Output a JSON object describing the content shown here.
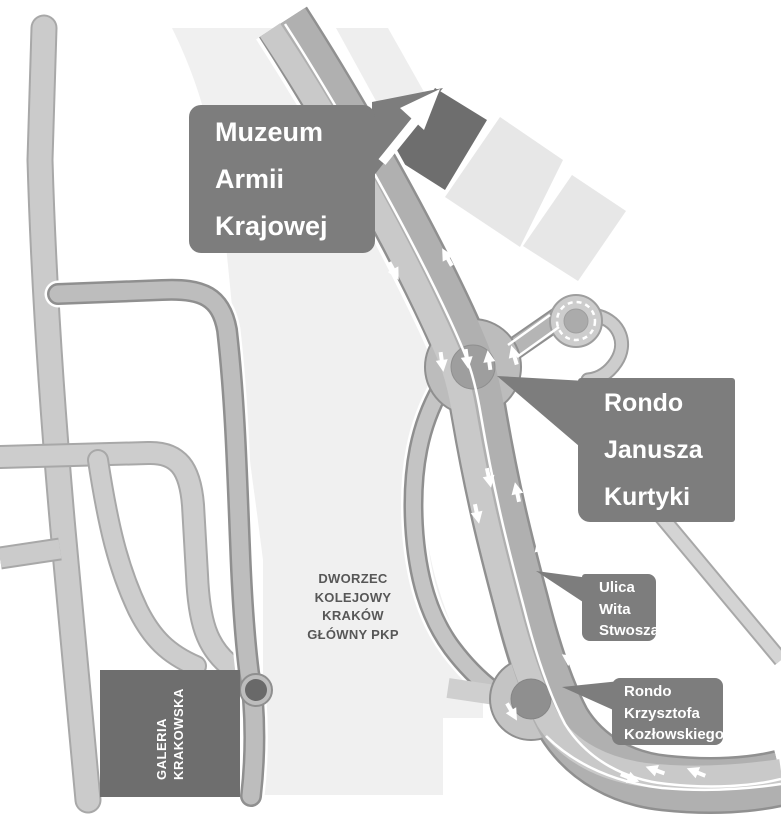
{
  "map": {
    "title_context": "Kraków Główny station area map",
    "labels": {
      "muzeum": "Muzeum\nArmii\nKrajowej",
      "rondo_kurtyki": "Rondo\nJanusza\nKurtyki",
      "ulica_wita": "Ulica\nWita\nStwosza",
      "rondo_kozlowski": "Rondo\nKrzysztofa\nKozłowskiego",
      "dworzec": "DWORZEC\nKOLEJOWY\nKRAKÓW\nGŁÓWNY PKP",
      "galeria": "GALERIA\nKRAKOWSKA"
    },
    "colors": {
      "callout_background": "#7d7d7d",
      "callout_text": "#ffffff",
      "dark_building": "#6e6e6e",
      "light_building": "#e7e7e7",
      "rail_station_band": "#f0f0f0",
      "road_light": "#cdcdcd",
      "road_medium_fill": "#bdbdbd",
      "road_edge": "#8f8f8f",
      "main_road_dark_lane": "#b0b0b0",
      "main_road_light_lane": "#c9c9c9",
      "roundabout_ring": "#bcbcbc",
      "roundabout_center": "#9e9e9e",
      "junction_dot": "#696969",
      "station_text": "#575757",
      "arrow": "#ffffff"
    },
    "icons": {
      "direction_arrows": "white traffic-direction arrows along carriageways",
      "roundabout_count": 3
    }
  }
}
